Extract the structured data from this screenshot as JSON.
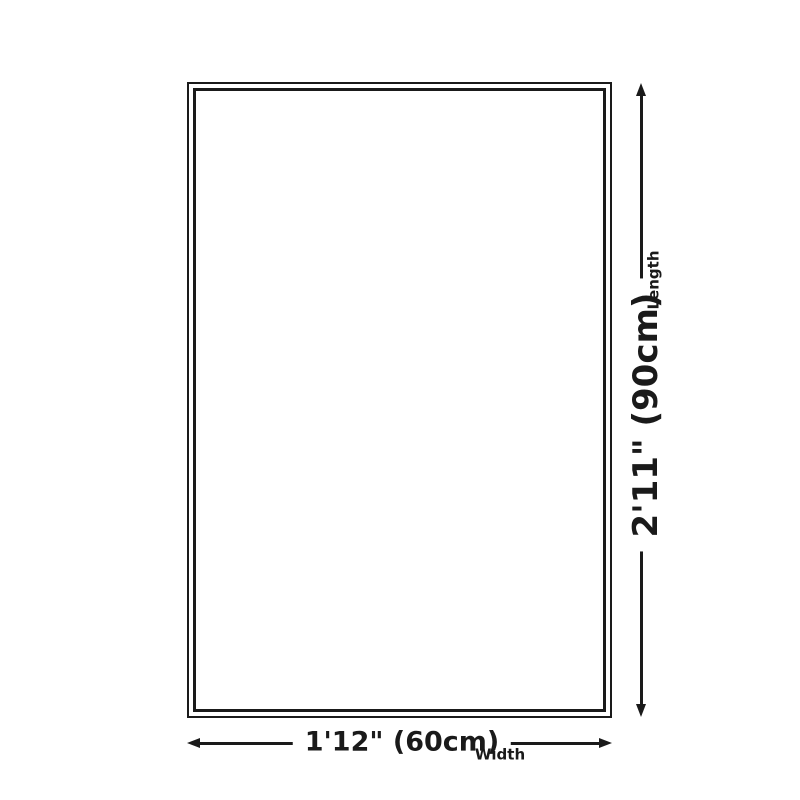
{
  "diagram": {
    "length": {
      "value": "2'11\" (90cm)",
      "label": "Length"
    },
    "width": {
      "value": "1'12\" (60cm)",
      "label": "Width"
    },
    "colors": {
      "line": "#1a1a1a",
      "background": "#ffffff"
    }
  }
}
